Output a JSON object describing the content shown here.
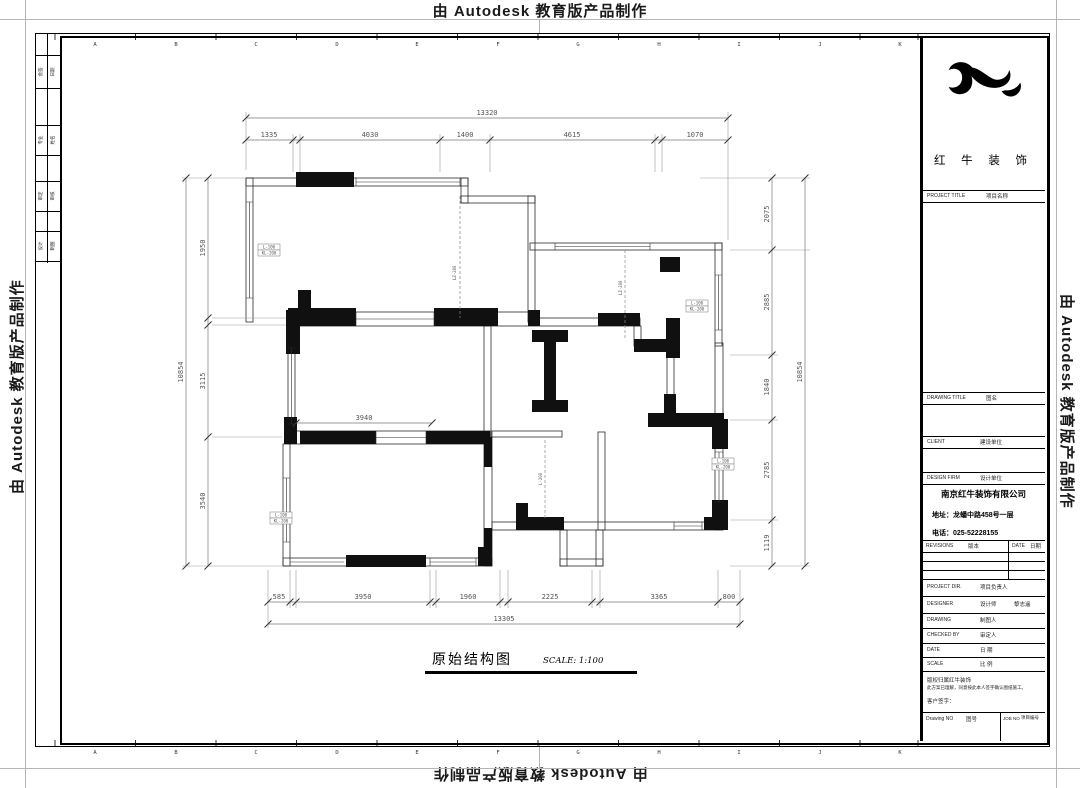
{
  "watermarks": {
    "top": "由 Autodesk 教育版产品制作",
    "bottom": "由 Autodesk 教育版产品制作",
    "left": "由 Autodesk 教育版产品制作",
    "right": "由 Autodesk 教育版产品制作"
  },
  "sheet": {
    "grid_letters": [
      "A",
      "B",
      "C",
      "D",
      "E",
      "F",
      "G",
      "H",
      "I",
      "J",
      "K"
    ]
  },
  "approval_strip": {
    "rows": [
      {
        "c1": "会签",
        "c2": "日期"
      },
      {
        "c1": "专业",
        "c2": "姓名"
      },
      {
        "c1": "审定",
        "c2": "审核"
      },
      {
        "c1": "设计",
        "c2": "制图"
      }
    ]
  },
  "title_block": {
    "brand": "红 牛 装 饰",
    "project_title_en": "PROJECT TITLE",
    "project_title_cn": "项目名称",
    "drawing_title_en": "DRAWING TITLE",
    "drawing_title_cn": "图名",
    "client_en": "CLIENT",
    "client_cn": "建设单位",
    "design_firm_en": "DESIGN FIRM",
    "design_firm_cn": "设计单位",
    "company_name": "南京红牛装饰有限公司",
    "company_address": "地址：龙蟠中路458号一层",
    "company_phone": "电话：025-52228155",
    "revisions_en": "REVISIONS",
    "revisions_cn": "版本",
    "date_col_en": "DATE",
    "date_col_cn": "日期",
    "project_dir_en": "PROJECT DIR.",
    "project_dir_cn": "项目负责人",
    "designer_en": "DESIGNER",
    "designer_cn": "设计师",
    "designer_value": "黎志遥",
    "drawing_en": "DRAWING",
    "drawing_cn": "制图人",
    "checked_en": "CHECKED BY",
    "checked_cn": "审定人",
    "date_en": "DATE",
    "date_cn": "日 期",
    "scale_en": "SCALE",
    "scale_cn": "比 例",
    "note_line1": "版权归属红牛装饰",
    "note_line2": "此方案已理解，同意按此本人签字确认图纸施工。",
    "note_line3": "客户签字：",
    "drawing_no_en": "Drawing NO",
    "drawing_no_cn": "图号",
    "job_no_en": "JOB NO",
    "job_no_cn": "项目编号"
  },
  "drawing_label": {
    "title": "原始结构图",
    "scale": "SCALE: 1:100"
  },
  "dimensions": {
    "top_total": "13320",
    "top": [
      "1335",
      "4030",
      "1400",
      "4615",
      "1070"
    ],
    "bottom": [
      "585",
      "3950",
      "1960",
      "2225",
      "3365",
      "800"
    ],
    "bottom_total": "13305",
    "left": [
      "1950",
      "3115",
      "3540"
    ],
    "left_total": "10854",
    "right": [
      "2075",
      "2885",
      "1840",
      "2785",
      "1119"
    ],
    "right_total": "10854",
    "interior": [
      "3940"
    ]
  },
  "plan": {
    "boxed_labels": [
      {
        "l1": "L-100",
        "l2": "KL-200"
      },
      {
        "l1": "L-100",
        "l2": "KL-200"
      },
      {
        "l1": "L-100",
        "l2": "KL-200"
      },
      {
        "l1": "L-100",
        "l2": "KL-200"
      }
    ],
    "dashed_labels": [
      "LZ-200",
      "LZ-200",
      "L-200"
    ]
  }
}
